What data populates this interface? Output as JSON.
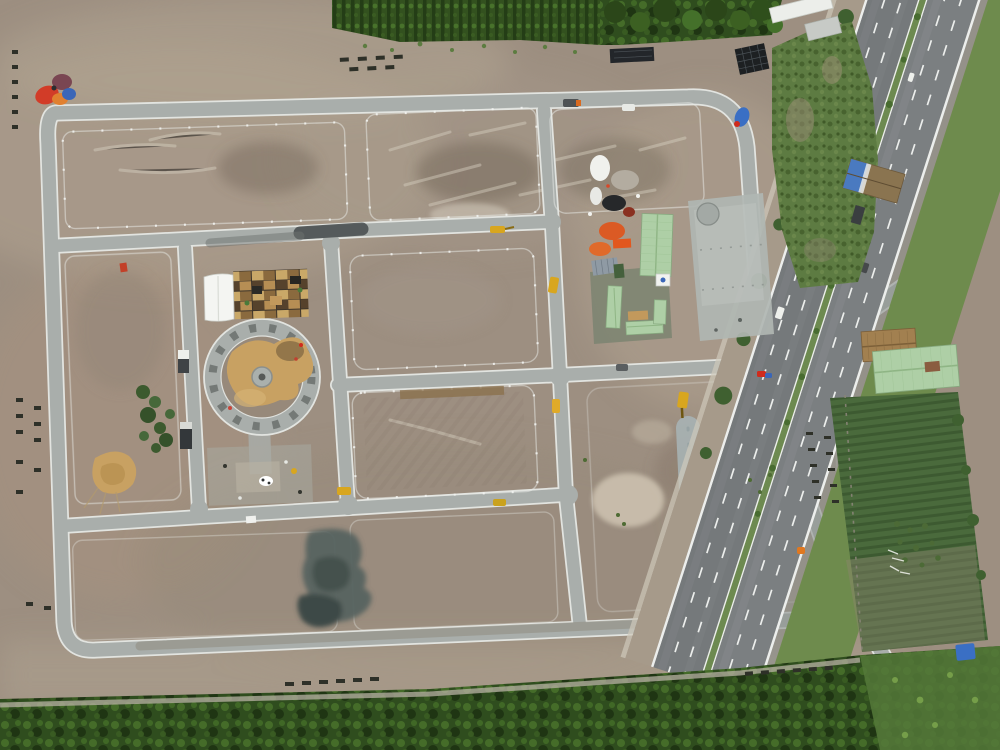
{
  "image": {
    "kind": "aerial-drone-photograph",
    "subject": "land development construction site with internal road grid, central roundabout under construction, site offices with green roofs, dirt lots, bordered by plantation forest strips and a multi-lane highway",
    "width_px": 1000,
    "height_px": 750
  },
  "scene": {
    "regions": [
      {
        "name": "top-forest-strip",
        "description": "plantation tree rows along the top edge"
      },
      {
        "name": "bottom-forest-strip",
        "description": "dense dark green forest along the bottom edge"
      },
      {
        "name": "northeast-scrub-field",
        "description": "green scrub between site and highway, with tarp-roofed shed"
      },
      {
        "name": "southeast-crop-field",
        "description": "dark green crop field with thatched and green metal-roof farm buildings"
      },
      {
        "name": "highway",
        "description": "dual-carriageway highway with planted median, running diagonally along right edge"
      },
      {
        "name": "site-road-grid",
        "description": "new light-gray concrete roads with white edge lines forming rectangular blocks"
      },
      {
        "name": "roundabout",
        "description": "circular concrete roundabout under construction with sand mound in center"
      },
      {
        "name": "site-office-compound",
        "description": "cluster of light-green metal roofs around a courtyard, white tent and pallet materials yard"
      },
      {
        "name": "dirt-blocks",
        "description": "graded brown earth lots with scrape marks, pale patches and a dark wet-concrete slab"
      }
    ],
    "object_counts": {
      "roundabout": 1,
      "green_roof_buildings": 5,
      "excavators_and_machines": 8,
      "trucks": 6,
      "highway_carriageways": 2
    }
  },
  "palette": {
    "dirt_base": "#9d8f81",
    "dirt_light": "#b3a493",
    "dirt_pale": "#cfc3b2",
    "dirt_pink": "#a8937f",
    "mud_dark": "#6f6252",
    "scratch_white": "#d8d0c2",
    "road_concrete": "#a9aeab",
    "road_edge": "#e2e4e0",
    "road_dirty": "#8f8c7f",
    "road_dark_patch": "#474b4c",
    "drain_strip": "#a7b2b4",
    "slab_teal": "#56635f",
    "slab_teal_dark": "#45514d",
    "highway_asphalt": "#75797b",
    "highway_asphalt2": "#7b7f81",
    "lane_white": "#eceeec",
    "service_dirt": "#a69a8a",
    "median_green": "#6d8a50",
    "grass_east": "#6e8b4d",
    "forest_dark": "#2f4d1e",
    "forest_mid": "#33511f",
    "forest_row_dark": "#243d16",
    "tree_crown": "#4e7a2e",
    "scrub_green": "#5d7b42",
    "field_green": "#4a6a3c",
    "field_row": "#3d5a31",
    "roof_green": "#aecfa6",
    "roof_ridge": "#8fb585",
    "roof_bluegray": "#8f9aa4",
    "roof_white": "#f0f2ef",
    "courtyard_green": "#7b8471",
    "tarp_blue": "#3a6fc4",
    "thatch_brown": "#a28050",
    "wood_tan": "#c2995c",
    "sand_tan": "#c8a162",
    "sand_dark": "#8a6f46",
    "orange_accent": "#e2571e",
    "red_accent": "#cf2b1d",
    "machine_yellow": "#d8a61f",
    "dark_object": "#2e3028",
    "white_detail": "#eef0ec"
  }
}
